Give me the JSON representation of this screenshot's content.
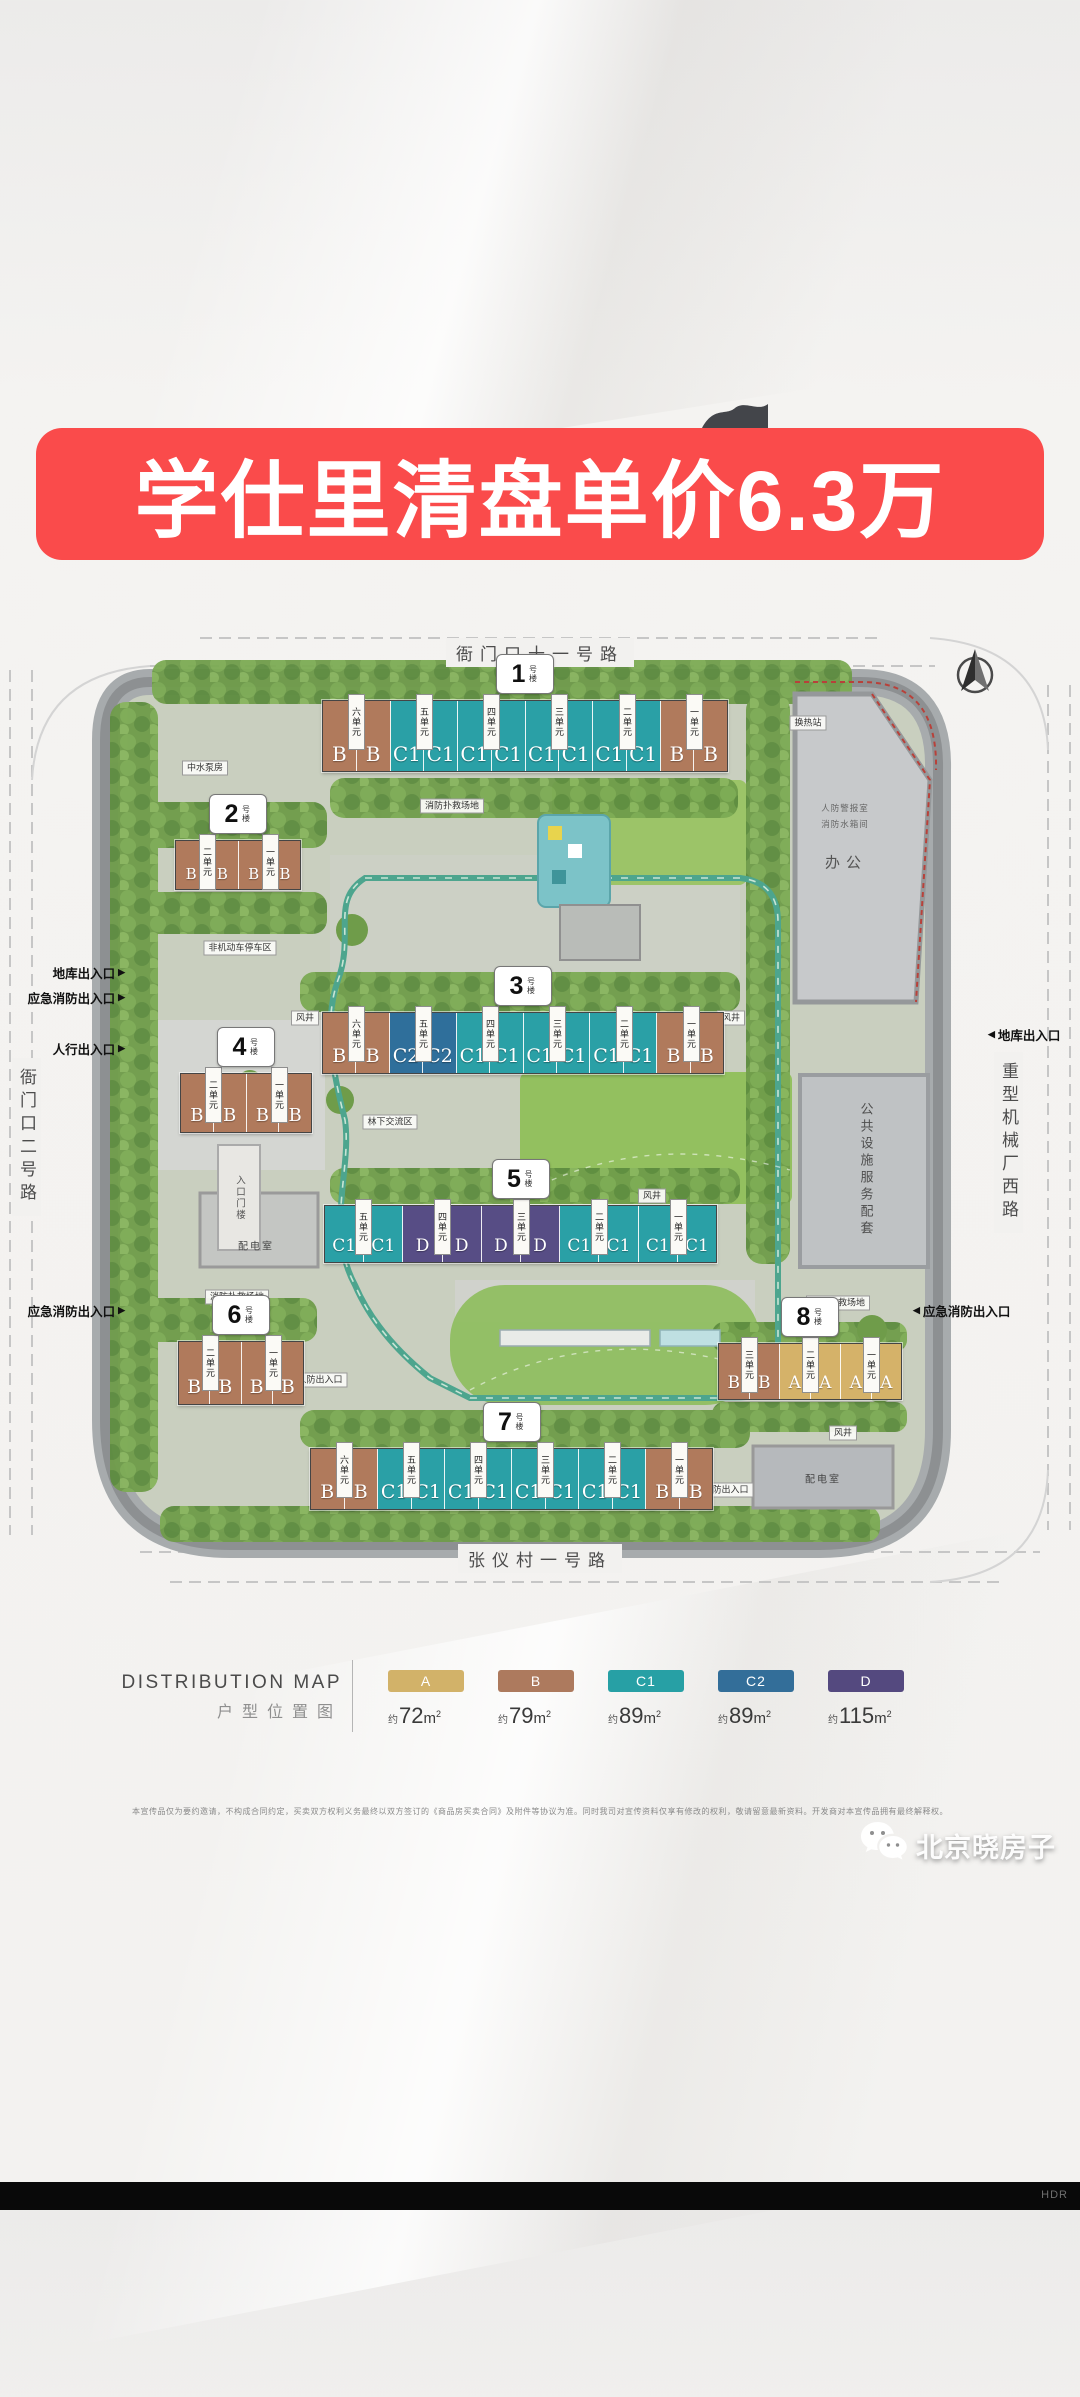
{
  "banner": {
    "title": "学仕里清盘单价6.3万"
  },
  "compass": {
    "icon": "north-arrow"
  },
  "roads": {
    "top": "衙门口十一号路",
    "left": "衙门口二号路",
    "right": "重型机械厂西路",
    "bottom": "张仪村一号路"
  },
  "colors": {
    "A": "#d5b269",
    "B": "#b07a5c",
    "C1": "#2aa0a6",
    "C2": "#2f6f9b",
    "D": "#574d85"
  },
  "map": {
    "buildings": [
      {
        "no": "1",
        "suffix": "号楼",
        "units": [
          "B",
          "B",
          "C1",
          "C1",
          "C1",
          "C1",
          "C1",
          "C1",
          "C1",
          "C1",
          "B",
          "B"
        ],
        "tabs": [
          "六单元",
          "五单元",
          "四单元",
          "三单元",
          "二单元",
          "一单元"
        ]
      },
      {
        "no": "2",
        "suffix": "号楼",
        "units": [
          "B",
          "B",
          "B",
          "B"
        ],
        "tabs": [
          "二单元",
          "一单元"
        ]
      },
      {
        "no": "3",
        "suffix": "号楼",
        "units": [
          "B",
          "B",
          "C2",
          "C2",
          "C1",
          "C1",
          "C1",
          "C1",
          "C1",
          "C1",
          "B",
          "B"
        ],
        "tabs": [
          "六单元",
          "五单元",
          "四单元",
          "三单元",
          "二单元",
          "一单元"
        ]
      },
      {
        "no": "4",
        "suffix": "号楼",
        "units": [
          "B",
          "B",
          "B",
          "B"
        ],
        "tabs": [
          "二单元",
          "一单元"
        ]
      },
      {
        "no": "5",
        "suffix": "号楼",
        "units": [
          "C1",
          "C1",
          "D",
          "D",
          "D",
          "D",
          "C1",
          "C1",
          "C1",
          "C1"
        ],
        "tabs": [
          "五单元",
          "四单元",
          "三单元",
          "二单元",
          "一单元"
        ]
      },
      {
        "no": "6",
        "suffix": "号楼",
        "units": [
          "B",
          "B",
          "B",
          "B"
        ],
        "tabs": [
          "二单元",
          "一单元"
        ]
      },
      {
        "no": "7",
        "suffix": "号楼",
        "units": [
          "B",
          "B",
          "C1",
          "C1",
          "C1",
          "C1",
          "C1",
          "C1",
          "C1",
          "C1",
          "B",
          "B"
        ],
        "tabs": [
          "六单元",
          "五单元",
          "四单元",
          "三单元",
          "二单元",
          "一单元"
        ]
      },
      {
        "no": "8",
        "suffix": "号楼",
        "units": [
          "B",
          "B",
          "A",
          "A",
          "A",
          "A"
        ],
        "tabs": [
          "三单元",
          "二单元",
          "一单元"
        ]
      }
    ],
    "parcels": {
      "office": {
        "label": "办公",
        "line1": "人防警报室",
        "line2": "消防水箱间"
      },
      "public_service": {
        "label": "公共设施服务配套"
      },
      "power_room_left": {
        "label": "配电室"
      },
      "power_room_right": {
        "label": "配电室"
      },
      "gatehouse": {
        "label": "入口门楼"
      }
    },
    "entrances": [
      {
        "label": "地库出入口",
        "arrow": "▶",
        "side": "left"
      },
      {
        "label": "应急消防出入口",
        "arrow": "▶",
        "side": "left"
      },
      {
        "label": "人行出入口",
        "arrow": "▶",
        "side": "left"
      },
      {
        "label": "应急消防出入口",
        "arrow": "▶",
        "side": "left"
      },
      {
        "label": "地库出入口",
        "arrow": "◀",
        "side": "right"
      },
      {
        "label": "应急消防出入口",
        "arrow": "◀",
        "side": "right"
      }
    ],
    "chips": [
      {
        "label": "风井"
      },
      {
        "label": "风井"
      },
      {
        "label": "风井"
      },
      {
        "label": "风井"
      },
      {
        "label": "风井"
      },
      {
        "label": "消防扑救场地"
      },
      {
        "label": "消防扑救场地"
      },
      {
        "label": "消防扑救场地"
      },
      {
        "label": "人防出入口"
      },
      {
        "label": "人防出入口"
      },
      {
        "label": "非机动车停车区"
      },
      {
        "label": "林下交流区"
      },
      {
        "label": "换热站"
      },
      {
        "label": "中水泵房"
      }
    ]
  },
  "legend": {
    "title": "DISTRIBUTION MAP",
    "subtitle": "户型位置图",
    "approx_prefix": "约",
    "unit_base": "m",
    "unit_sup": "2",
    "items": [
      {
        "code": "A",
        "area": "72",
        "color": "#d2b269"
      },
      {
        "code": "B",
        "area": "79",
        "color": "#ad7a5e"
      },
      {
        "code": "C1",
        "area": "89",
        "color": "#27a0a5"
      },
      {
        "code": "C2",
        "area": "89",
        "color": "#336e99"
      },
      {
        "code": "D",
        "area": "115",
        "color": "#54497f"
      }
    ]
  },
  "disclaimer": "本宣传品仅为要约邀请，不构成合同约定，买卖双方权利义务最终以双方签订的《商品房买卖合同》及附件等协议为准。同时我司对宣传资料仅享有修改的权利，敬请留意最新资料。开发商对本宣传品拥有最终解释权。",
  "watermark": {
    "name": "北京晓房子",
    "icon": "wechat-logo"
  },
  "footer": {
    "hdr_label": "HDR"
  }
}
